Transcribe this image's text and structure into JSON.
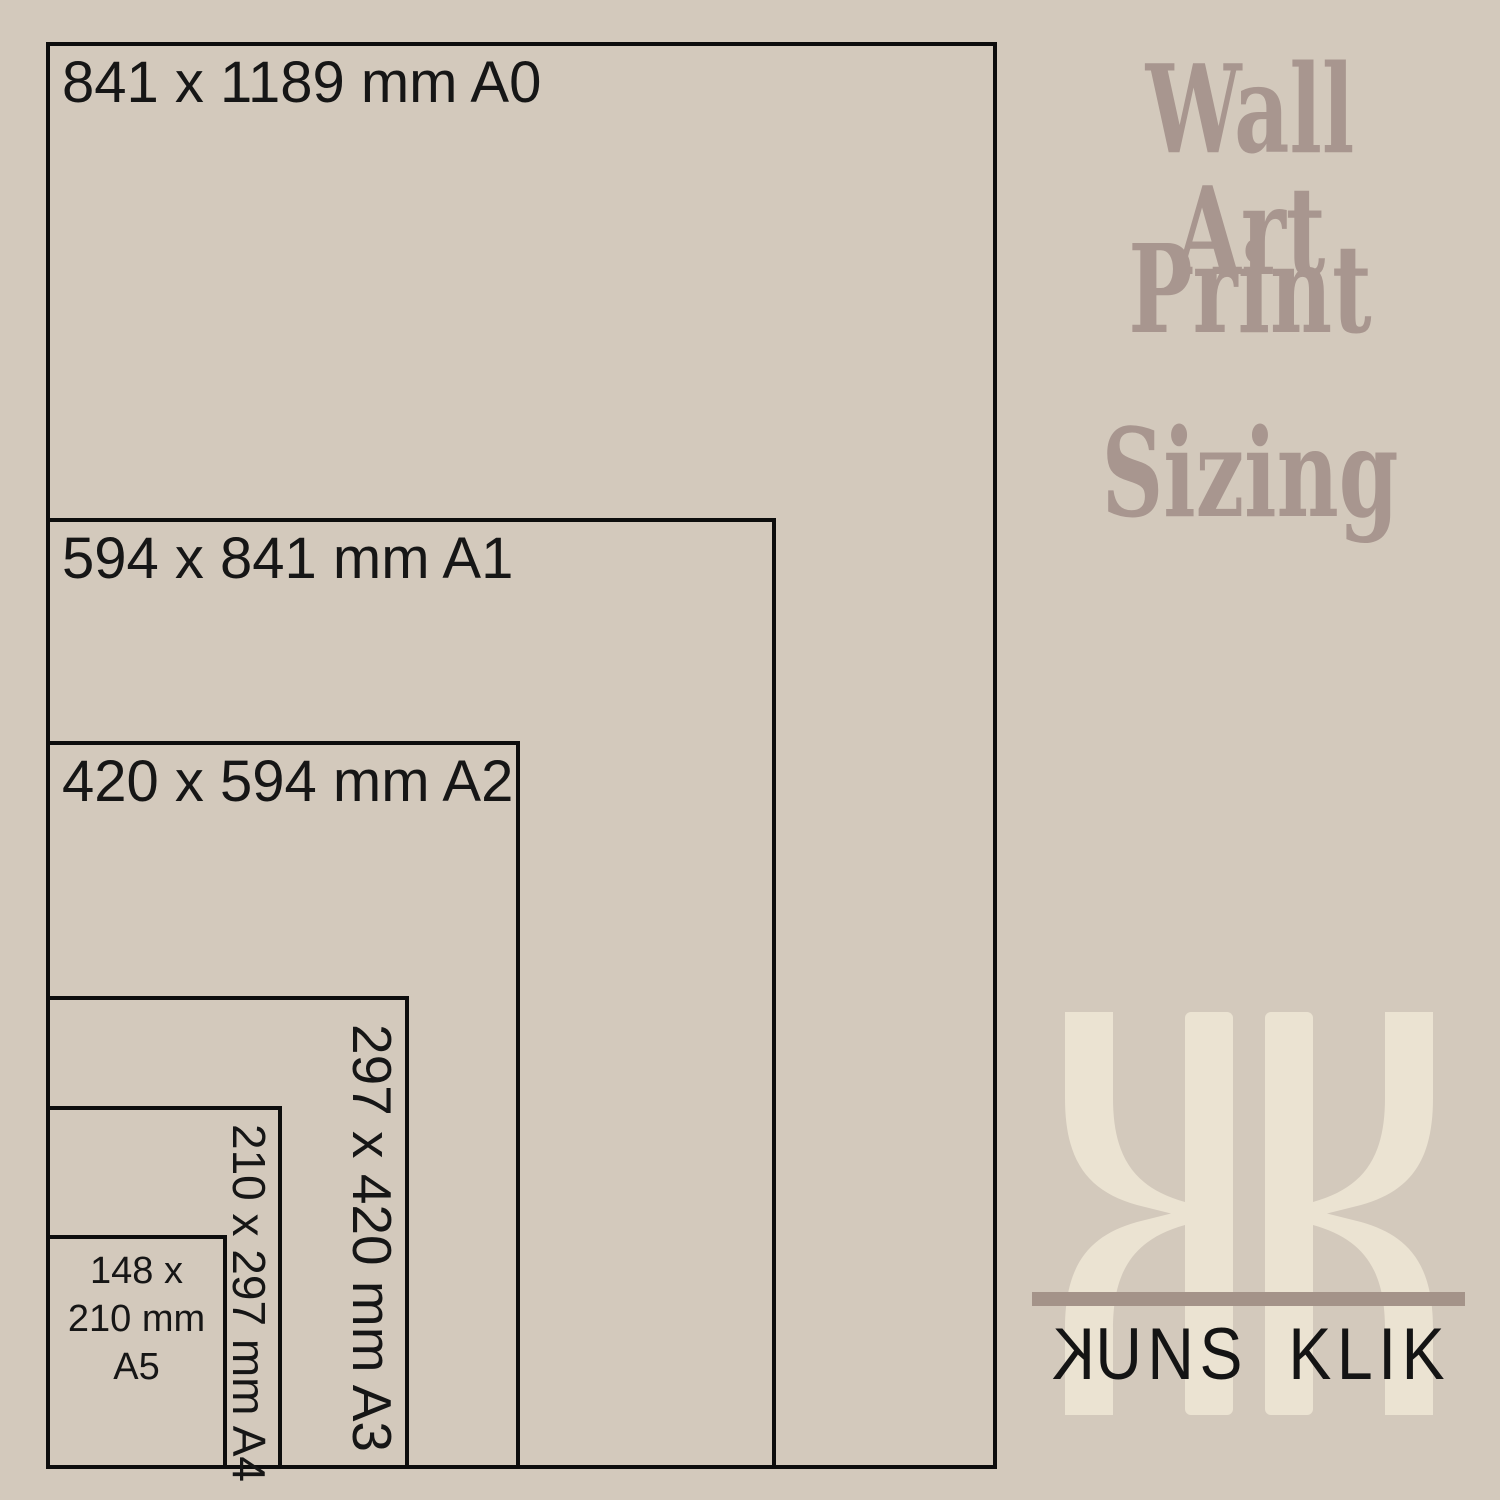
{
  "page": {
    "background": "#d3c9bc",
    "border_color": "#0d0d0d",
    "label_color": "#161616"
  },
  "diagram": {
    "description": "nested print size rectangles sharing left and bottom edges",
    "sizes": [
      {
        "id": "A0",
        "label": "841 x 1189 mm A0",
        "mode": "horiz",
        "left": 46,
        "top": 42,
        "width": 951,
        "height": 1427
      },
      {
        "id": "A1",
        "label": "594 x 841 mm A1",
        "mode": "horiz",
        "left": 46,
        "top": 518,
        "width": 730,
        "height": 951
      },
      {
        "id": "A2",
        "label": "420 x 594 mm A2",
        "mode": "horiz",
        "left": 46,
        "top": 741,
        "width": 474,
        "height": 728
      },
      {
        "id": "A3",
        "label": "297 x 420 mm A3",
        "mode": "rot",
        "left": 46,
        "top": 996,
        "width": 363,
        "height": 473
      },
      {
        "id": "A4",
        "label": "210 x 297 mm A4",
        "mode": "rot",
        "left": 46,
        "top": 1106,
        "width": 236,
        "height": 363
      },
      {
        "id": "A5",
        "label_lines": [
          "148 x",
          "210 mm",
          "A5"
        ],
        "mode": "center",
        "left": 46,
        "top": 1235,
        "width": 181,
        "height": 234
      }
    ]
  },
  "title": {
    "lines": [
      "Wall Art",
      "Print",
      "Sizing"
    ],
    "color": "#a8968f"
  },
  "logo": {
    "monogram": "KK",
    "monogram_color": "#ebe3d2",
    "bar_color": "#a49389",
    "text_color": "#141414",
    "wordmark": {
      "first_letter": "K",
      "first_word_rest": "UNS",
      "second_word": "KLIK"
    }
  }
}
